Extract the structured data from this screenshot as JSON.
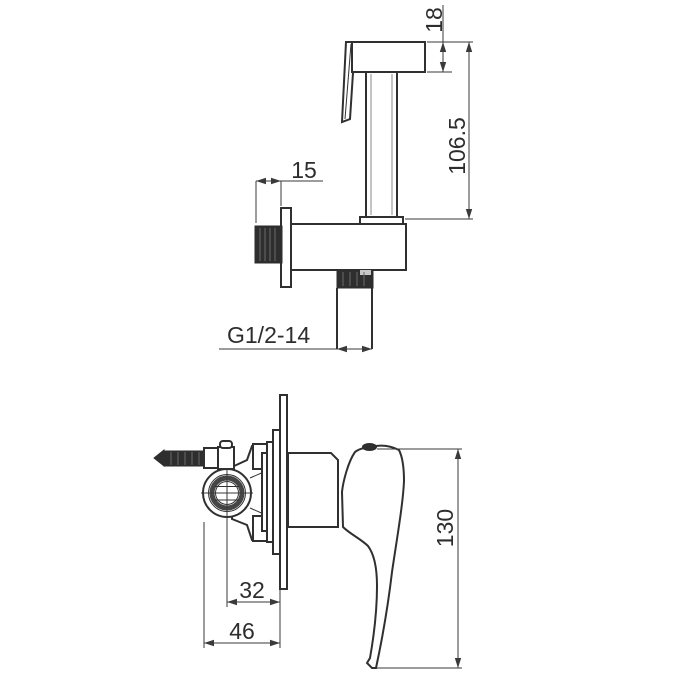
{
  "colors": {
    "background": "#ffffff",
    "line": "#303030",
    "dim_line": "#3a3a3a",
    "dark_fill": "#2e2e2e"
  },
  "sprayer_view": {
    "dim_head_height": "18",
    "dim_overall_height": "106.5",
    "dim_wall_offset": "15",
    "thread_spec": "G1/2-14"
  },
  "valve_view": {
    "dim_overall_height": "130",
    "dim_center_to_plate": "32",
    "dim_body_to_plate": "46"
  }
}
